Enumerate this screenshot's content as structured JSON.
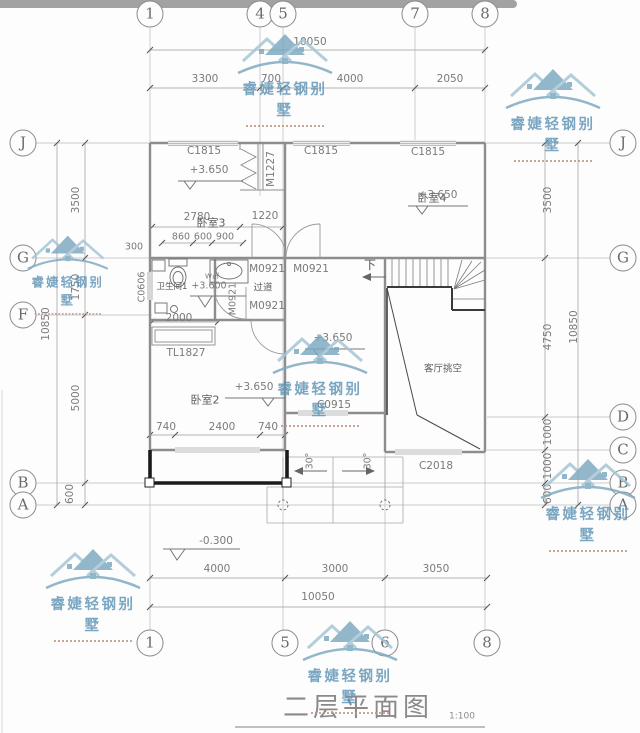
{
  "title": {
    "text": "二层平面图",
    "scale": "1:100"
  },
  "watermark": {
    "brand": "睿婕轻钢别墅",
    "color": "#7ba7bf"
  },
  "grid": {
    "top": [
      "1",
      "4",
      "5",
      "7",
      "8"
    ],
    "bottom": [
      "1",
      "5",
      "6",
      "8"
    ],
    "left": [
      "J",
      "G",
      "F",
      "B",
      "A"
    ],
    "right": [
      "J",
      "G",
      "D",
      "C",
      "B",
      "A"
    ]
  },
  "dims": {
    "top": {
      "overall": "10050",
      "segments": [
        "3300",
        "700",
        "4000",
        "2050"
      ]
    },
    "bottom": {
      "overall": "10050",
      "segments": [
        "4000",
        "3000",
        "3050"
      ]
    },
    "left": {
      "overall": "10850",
      "segments": [
        "3500",
        "1750",
        "5000",
        "600"
      ]
    },
    "right": {
      "overall": "10850",
      "segments": [
        "3500",
        "4750",
        "1000",
        "1000",
        "600"
      ]
    },
    "interior": {
      "bed3_width": "2780",
      "closet": "1220",
      "seg_860": "860",
      "seg_600": "600",
      "seg_900": "900",
      "wall_300": "300",
      "bath_width": "2000",
      "bed2_740a": "740",
      "bed2_2400": "2400",
      "bed2_740b": "740"
    }
  },
  "rooms": {
    "bed3": "卧室3",
    "bed4": "卧室4",
    "bath1": "卫生间1",
    "corridor": "过道",
    "bed2": "卧室2",
    "void": "客厅挑空"
  },
  "openings": {
    "c1815": "C1815",
    "m1227": "M1227",
    "c0606": "C0606",
    "m0921": "M0921",
    "tl1827": "TL1827",
    "c0915": "C0915",
    "c2018": "C2018"
  },
  "levels": {
    "l365": "+3.650",
    "l360": "+3.600",
    "lm03": "-0.300"
  },
  "annotations": {
    "down": "下",
    "slope": "30°",
    "washer": "W㎡"
  }
}
